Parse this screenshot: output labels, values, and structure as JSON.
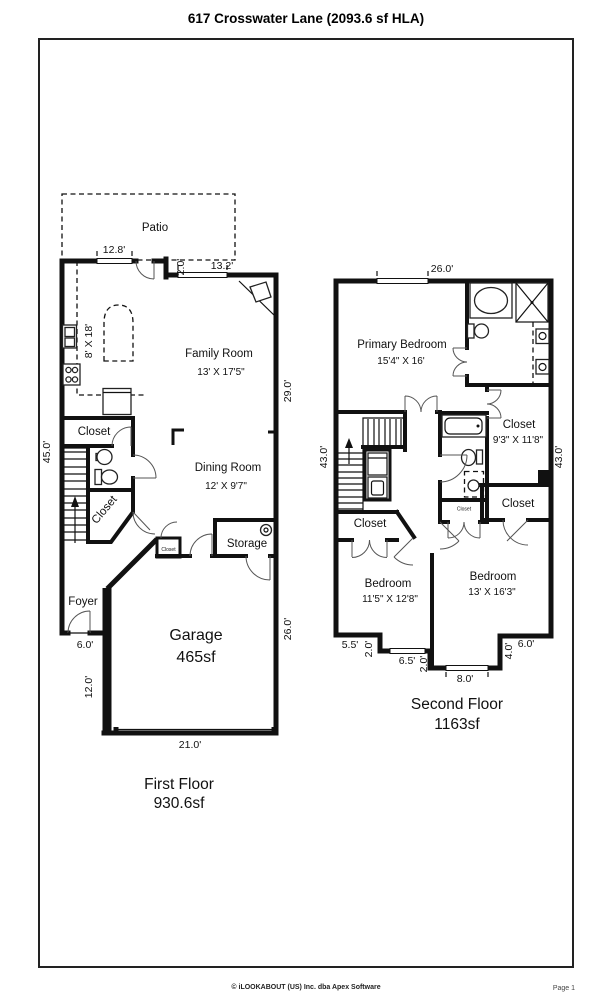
{
  "title": "617 Crosswater Lane (2093.6 sf HLA)",
  "footer": {
    "copyright": "© iLOOKABOUT (US) Inc. dba Apex Software",
    "page": "Page 1"
  },
  "first_floor": {
    "floor_name": "First Floor",
    "floor_area": "930.6sf",
    "patio": "Patio",
    "family_room": {
      "name": "Family Room",
      "size": "13' X 17'5\""
    },
    "dining_room": {
      "name": "Dining Room",
      "size": "12' X 9'7\""
    },
    "garage": {
      "name": "Garage",
      "size": "465sf"
    },
    "foyer": "Foyer",
    "storage": "Storage",
    "closet_upper": "Closet",
    "closet_stairs": "Closet",
    "closet_hall": "Closet",
    "island": "8' X 18'",
    "dims": {
      "d12_8": "12.8'",
      "d2_0": "2.0'",
      "d13_2": "13.2'",
      "d29_0": "29.0'",
      "d45_0": "45.0'",
      "d26_0": "26.0'",
      "d6_0": "6.0'",
      "d12_0": "12.0'",
      "d21_0": "21.0'"
    }
  },
  "second_floor": {
    "floor_name": "Second Floor",
    "floor_area": "1163sf",
    "primary_bedroom": {
      "name": "Primary Bedroom",
      "size": "15'4\" X 16'"
    },
    "primary_closet": {
      "name": "Closet",
      "size": "9'3\" X 11'8\""
    },
    "bedroom_left": {
      "name": "Bedroom",
      "size": "11'5\" X 12'8\""
    },
    "bedroom_right": {
      "name": "Bedroom",
      "size": "13' X 16'3\""
    },
    "closet_left": "Closet",
    "closet_small": "Closet",
    "closet_right": "Closet",
    "dims": {
      "d26_0": "26.0'",
      "d43_0_left": "43.0'",
      "d43_0_right": "43.0'",
      "d5_5": "5.5'",
      "d2_0_a": "2.0'",
      "d6_5": "6.5'",
      "d2_0_b": "2.0'",
      "d8_0": "8.0'",
      "d4_0": "4.0'",
      "d6_0": "6.0'"
    }
  }
}
